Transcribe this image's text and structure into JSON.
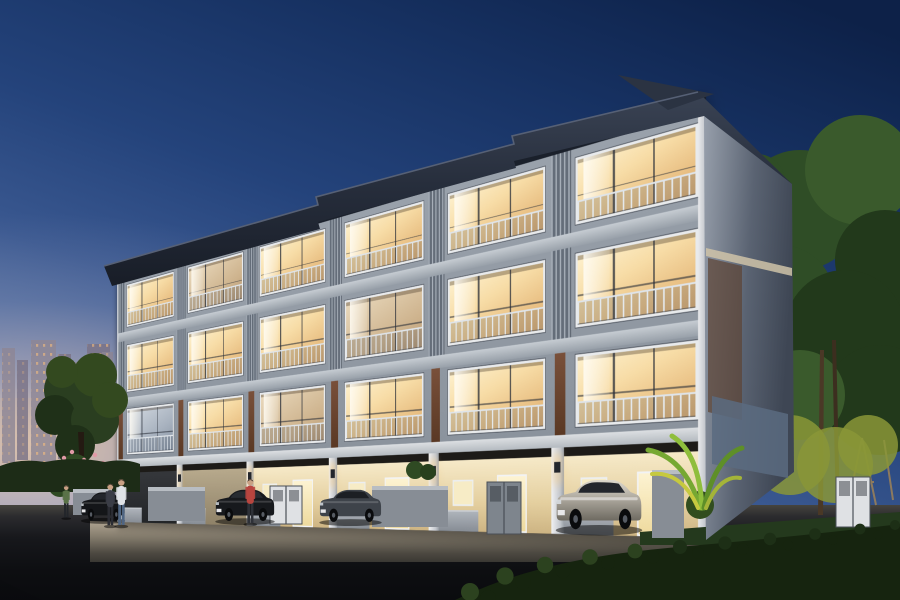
{
  "meta": {
    "kind": "architectural-dusk-render",
    "subject": "four-storey townhome row at twilight",
    "width": 900,
    "height": 600
  },
  "palette": {
    "sky_top": "#0d2148",
    "sky_mid": "#24437b",
    "sky_horizon": "#b3aeb4",
    "horizon_glow": "#ebcdb2",
    "roof": "#232936",
    "roof_edge": "#4a5466",
    "facade_grey": "#8d959f",
    "spandrel": "#c6ccd2",
    "louver_light": "#a6aeb8",
    "louver_dark": "#646d79",
    "accent_brown": "#6b452f",
    "window_warm": "#f7dca6",
    "window_cool": "#a8b2bf",
    "frame_white": "#e8eaec",
    "carport_light": "#f6e9c8",
    "ground_wall": "#9aa0a8",
    "road": "#0d0e11",
    "driveway": "#d8ccb6",
    "hedge_dark": "#16240f",
    "hedge_mid": "#24391d",
    "tree_green": "#2f4d26",
    "tree_lit": "#8a9637",
    "skyline": "#8e8695",
    "skyline_lights": "#ffc27a",
    "car_black": "#17191d",
    "car_grey": "#3e434a",
    "car_silver_hi": "#ddd8cc",
    "car_silver_lo": "#6e6a61",
    "sconce_glow": "#ffd68c"
  },
  "building": {
    "units": 6,
    "floors_visible": 4,
    "light_matrix": {
      "f4": [
        "warm",
        "dim",
        "warm",
        "warm",
        "warm",
        "warm"
      ],
      "f3": [
        "warm",
        "warm",
        "warm",
        "dim",
        "warm",
        "warm"
      ],
      "f2": [
        "cool",
        "warm",
        "dim",
        "warm",
        "warm",
        "warm"
      ],
      "ground": [
        "dark",
        "dim",
        "warm",
        "warm",
        "warm",
        "warm"
      ]
    }
  },
  "scene": {
    "skyline_towers": [
      [
        2,
        348,
        13,
        115
      ],
      [
        17,
        360,
        11,
        100
      ],
      [
        31,
        340,
        25,
        125
      ],
      [
        58,
        354,
        13,
        105
      ],
      [
        73,
        362,
        11,
        95
      ],
      [
        87,
        344,
        23,
        70
      ],
      [
        102,
        352,
        11,
        60
      ]
    ],
    "tree_left": [
      [
        70,
        390,
        26,
        "a"
      ],
      [
        95,
        375,
        22,
        "b"
      ],
      [
        55,
        415,
        20,
        "c"
      ],
      [
        95,
        420,
        24,
        "a"
      ],
      [
        75,
        445,
        20,
        "c"
      ],
      [
        110,
        400,
        18,
        "b"
      ],
      [
        62,
        372,
        16,
        "b"
      ]
    ],
    "flower_bush": [
      [
        75,
        470,
        16
      ],
      [
        95,
        480,
        14
      ],
      [
        60,
        485,
        12
      ],
      [
        108,
        476,
        11
      ]
    ],
    "flower_dots": [
      [
        64,
        458
      ],
      [
        72,
        452
      ],
      [
        84,
        460
      ],
      [
        95,
        455
      ],
      [
        103,
        463
      ],
      [
        60,
        472
      ],
      [
        70,
        478
      ],
      [
        88,
        470
      ],
      [
        99,
        482
      ],
      [
        80,
        490
      ],
      [
        66,
        492
      ],
      [
        106,
        488
      ]
    ],
    "trees_right": [
      [
        800,
        210,
        60,
        "a"
      ],
      [
        860,
        170,
        55,
        "b"
      ],
      [
        885,
        260,
        50,
        "c"
      ],
      [
        780,
        300,
        55,
        "a"
      ],
      [
        845,
        330,
        60,
        "c"
      ],
      [
        880,
        400,
        55,
        "c"
      ],
      [
        800,
        395,
        45,
        "b"
      ],
      [
        757,
        182,
        28,
        "a"
      ],
      [
        742,
        250,
        24,
        "b"
      ]
    ],
    "trees_right_lit": [
      [
        790,
        455,
        40
      ],
      [
        835,
        465,
        38
      ],
      [
        868,
        445,
        30
      ]
    ],
    "walls": [
      [
        73,
        489,
        39,
        26
      ],
      [
        148,
        487,
        57,
        34
      ],
      [
        372,
        486,
        76,
        41
      ],
      [
        652,
        470,
        32,
        68
      ]
    ],
    "cabinets": [
      {
        "x": 270,
        "y": 486,
        "w": 32,
        "h": 38,
        "tone": "white"
      },
      {
        "x": 487,
        "y": 482,
        "w": 34,
        "h": 52,
        "tone": "grey"
      },
      {
        "x": 836,
        "y": 477,
        "w": 34,
        "h": 50,
        "tone": "white"
      }
    ],
    "cars": [
      {
        "name": "car-suv-left-black",
        "type": "sedan",
        "x": 80,
        "y": 489,
        "w": 46,
        "h": 34,
        "body": "#141619",
        "glass": "#23262b"
      },
      {
        "name": "car-sedan-black",
        "type": "sedan",
        "x": 214,
        "y": 486,
        "w": 62,
        "h": 38,
        "body": "#17191d",
        "glass": "#272b31"
      },
      {
        "name": "car-sedan-grey",
        "type": "sedan",
        "x": 318,
        "y": 486,
        "w": 65,
        "h": 39,
        "body": "#3e434a",
        "glass": "#1c1f24"
      },
      {
        "name": "car-suv-silver",
        "type": "suv",
        "x": 554,
        "y": 474,
        "w": 90,
        "h": 60,
        "body": "silver",
        "glass": "#23262c"
      }
    ],
    "people": [
      {
        "name": "person-green-shirt",
        "x": 66,
        "y": 484,
        "h": 35,
        "top": "#5a7248",
        "bottom": "#23262b"
      },
      {
        "name": "person-dark-dress",
        "x": 110,
        "y": 482,
        "h": 45,
        "top": "#3a3d46",
        "bottom": "#2a2c33"
      },
      {
        "name": "person-white-shirt",
        "x": 121,
        "y": 477,
        "h": 50,
        "top": "#dfe2e6",
        "bottom": "#4f6582"
      },
      {
        "name": "person-red-top",
        "x": 250,
        "y": 477,
        "h": 48,
        "top": "#b8453f",
        "bottom": "#2e3138"
      }
    ]
  }
}
